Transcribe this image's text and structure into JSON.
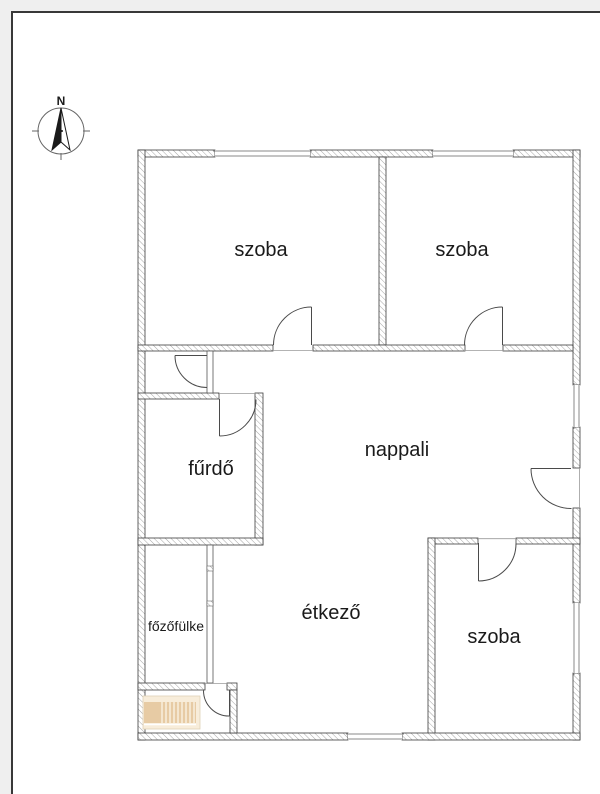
{
  "compass": {
    "label": "N"
  },
  "rooms": {
    "szoba_top_left": {
      "label": "szoba"
    },
    "szoba_top_right": {
      "label": "szoba"
    },
    "nappali": {
      "label": "nappali"
    },
    "furdo": {
      "label": "fűrdő"
    },
    "etkezo": {
      "label": "étkező"
    },
    "fozofulke": {
      "label": "főzőfülke"
    },
    "szoba_bottom": {
      "label": "szoba"
    }
  },
  "colors": {
    "stair_base": "#f8edda",
    "stair_tread": "#e7cba4",
    "wall_outline": "#3c3c3c",
    "hatch_line": "#9b9b9b",
    "page_margin": "#efefef",
    "page_border": "#383838",
    "text": "#1a1a1a"
  }
}
